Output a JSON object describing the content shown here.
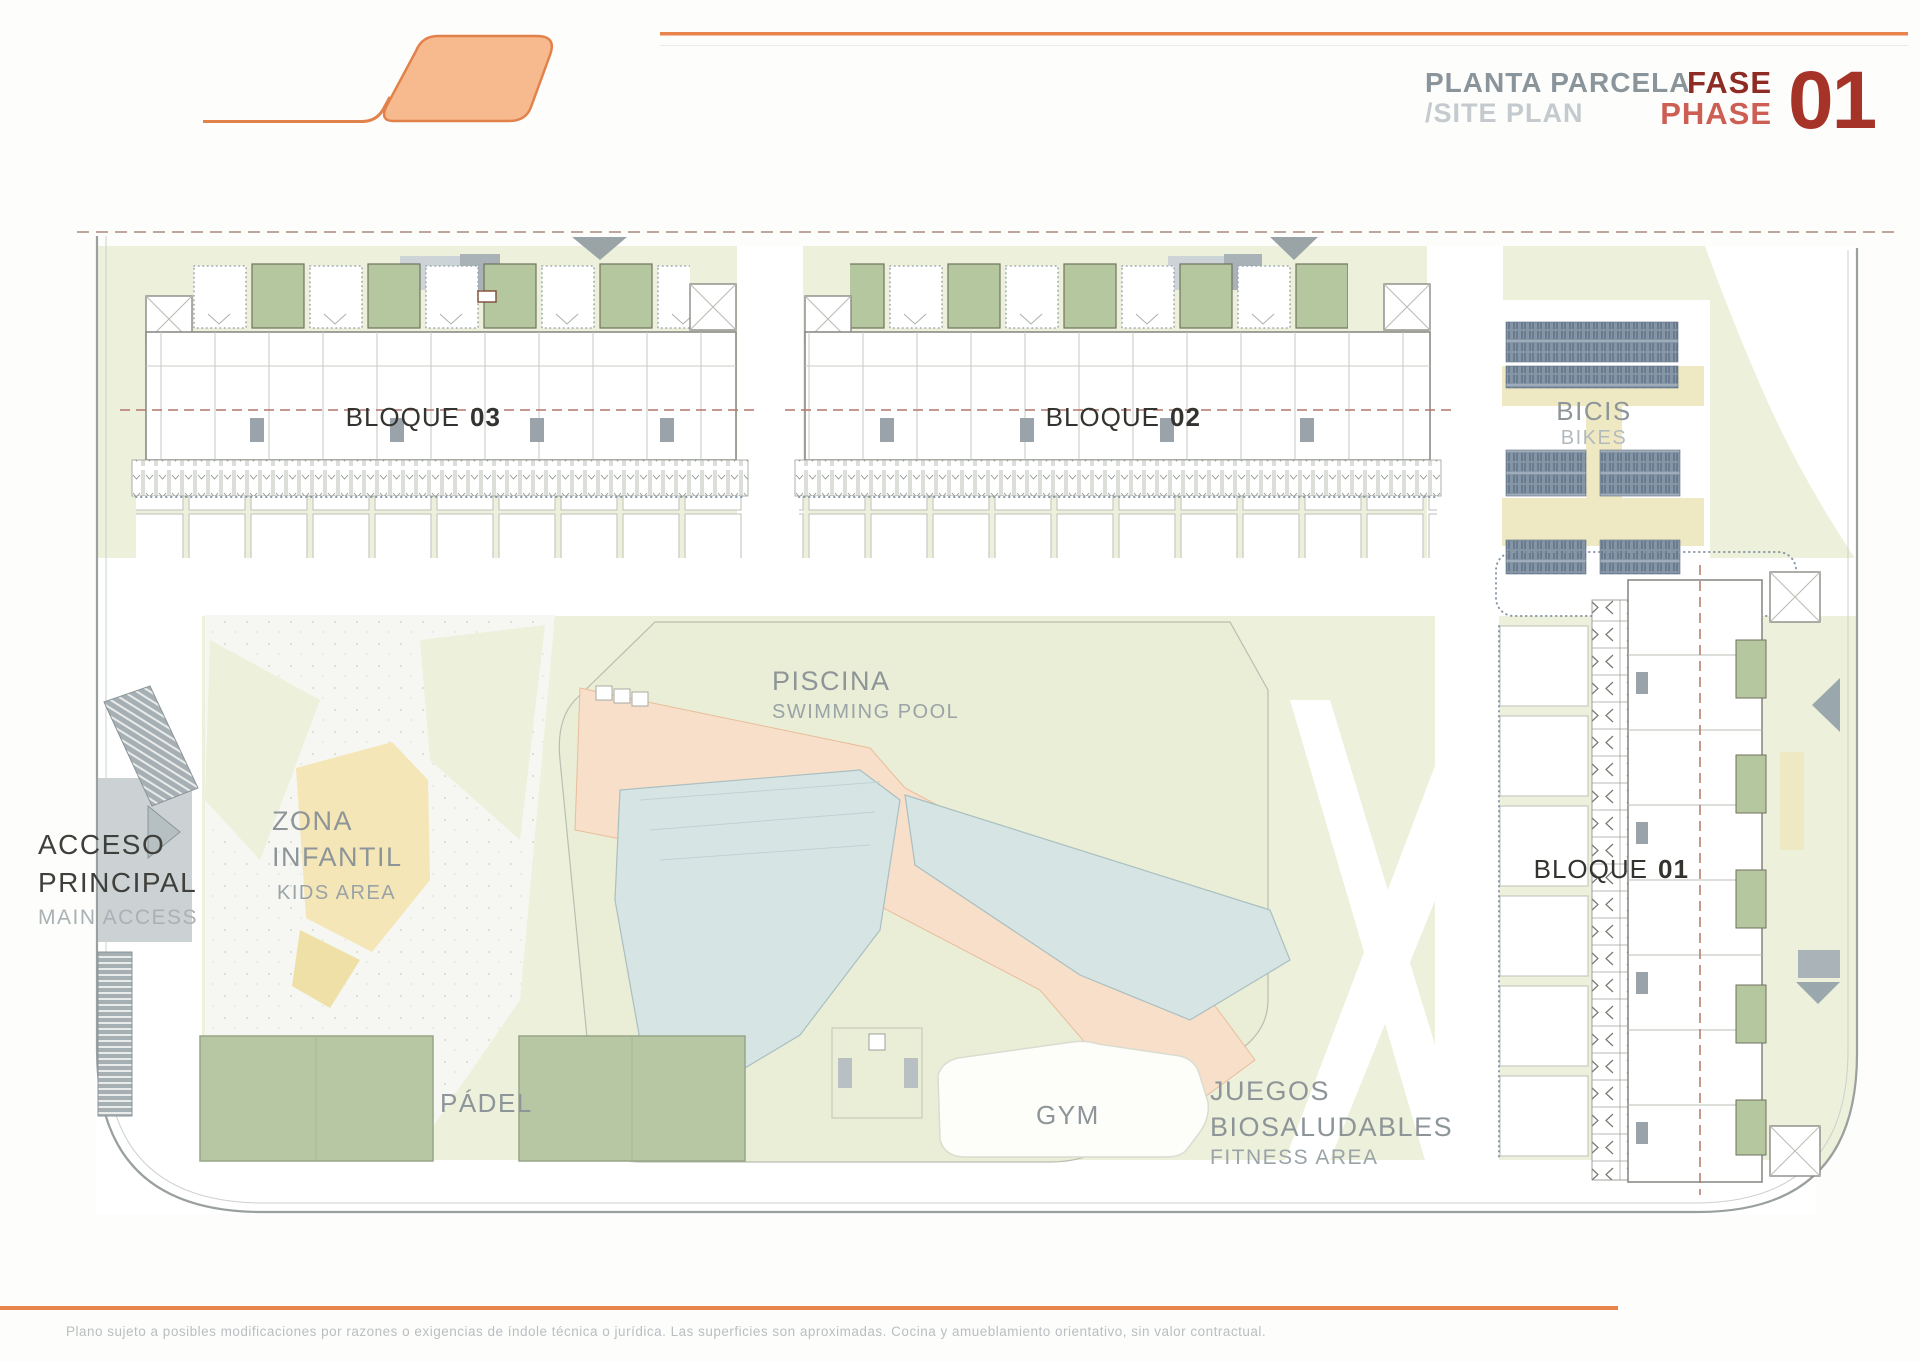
{
  "header": {
    "title_es": "PLANTA PARCELA",
    "title_en": "/SITE PLAN",
    "fase": "FASE",
    "phase": "PHASE",
    "phase_number": "01"
  },
  "plan": {
    "blocks": {
      "word": "BLOQUE",
      "b01": "01",
      "b02": "02",
      "b03": "03"
    },
    "bikes": {
      "es": "BICIS",
      "en": "BIKES"
    },
    "pool": {
      "es": "PISCINA",
      "en": "SWIMMING POOL"
    },
    "kids": {
      "es_line1": "ZONA",
      "es_line2": "INFANTIL",
      "en": "KIDS AREA"
    },
    "access": {
      "es_line1": "ACCESO",
      "es_line2": "PRINCIPAL",
      "en": "MAIN ACCESS"
    },
    "padel": {
      "es": "PÁDEL"
    },
    "gym": {
      "es": "GYM"
    },
    "fitness": {
      "es_line1": "JUEGOS",
      "es_line2": "BIOSALUDABLES",
      "en": "FITNESS AREA"
    }
  },
  "footer": {
    "disclaimer": "Plano sujeto a posibles modificaciones por razones o exigencias de índole técnica o jurídica. Las superficies son aproximadas. Cocina y amueblamiento orientativo, sin valor contractual."
  },
  "colors": {
    "accent_orange": "#E8854D",
    "logo_fill": "#F7B98E",
    "landscape_green": "#EDF0DA",
    "court_green": "#B7C6A3",
    "terrace_green": "#B5C79E",
    "pool_blue": "#D6E4E4",
    "deck_peach": "#F8DFC9",
    "kids_yellow": "#F3E5B2",
    "bike_yellow": "#EFE9C3",
    "rack_blue": "#8595A6",
    "road_gray": "#CCD2D3",
    "boundary_gray": "#99A09D",
    "dashed_red": "#B4766C",
    "dashed_boundary": "#BFA69C",
    "fase_dark": "#8E2B24",
    "number_red": "#A53327"
  }
}
